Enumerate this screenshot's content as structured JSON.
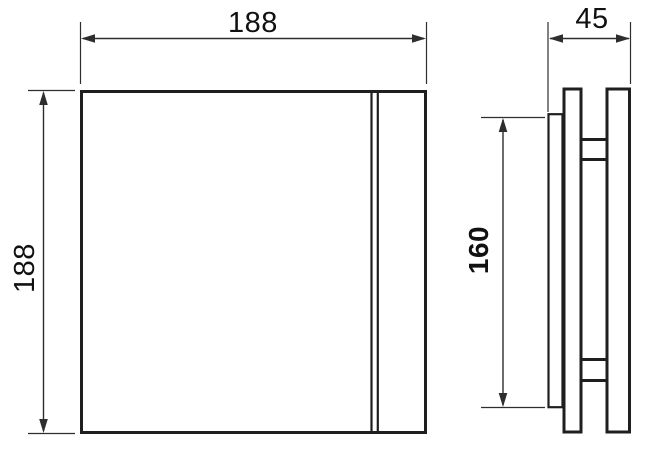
{
  "drawing": {
    "type": "technical-dimension-drawing",
    "views": {
      "front": {
        "width_label": "188",
        "height_label": "188"
      },
      "side": {
        "depth_label": "45",
        "mount_height_label": "160"
      }
    },
    "colors": {
      "object_line": "#1f1f1f",
      "dimension_line": "#2e2e2e",
      "label_text": "#111111",
      "background": "#ffffff"
    }
  }
}
